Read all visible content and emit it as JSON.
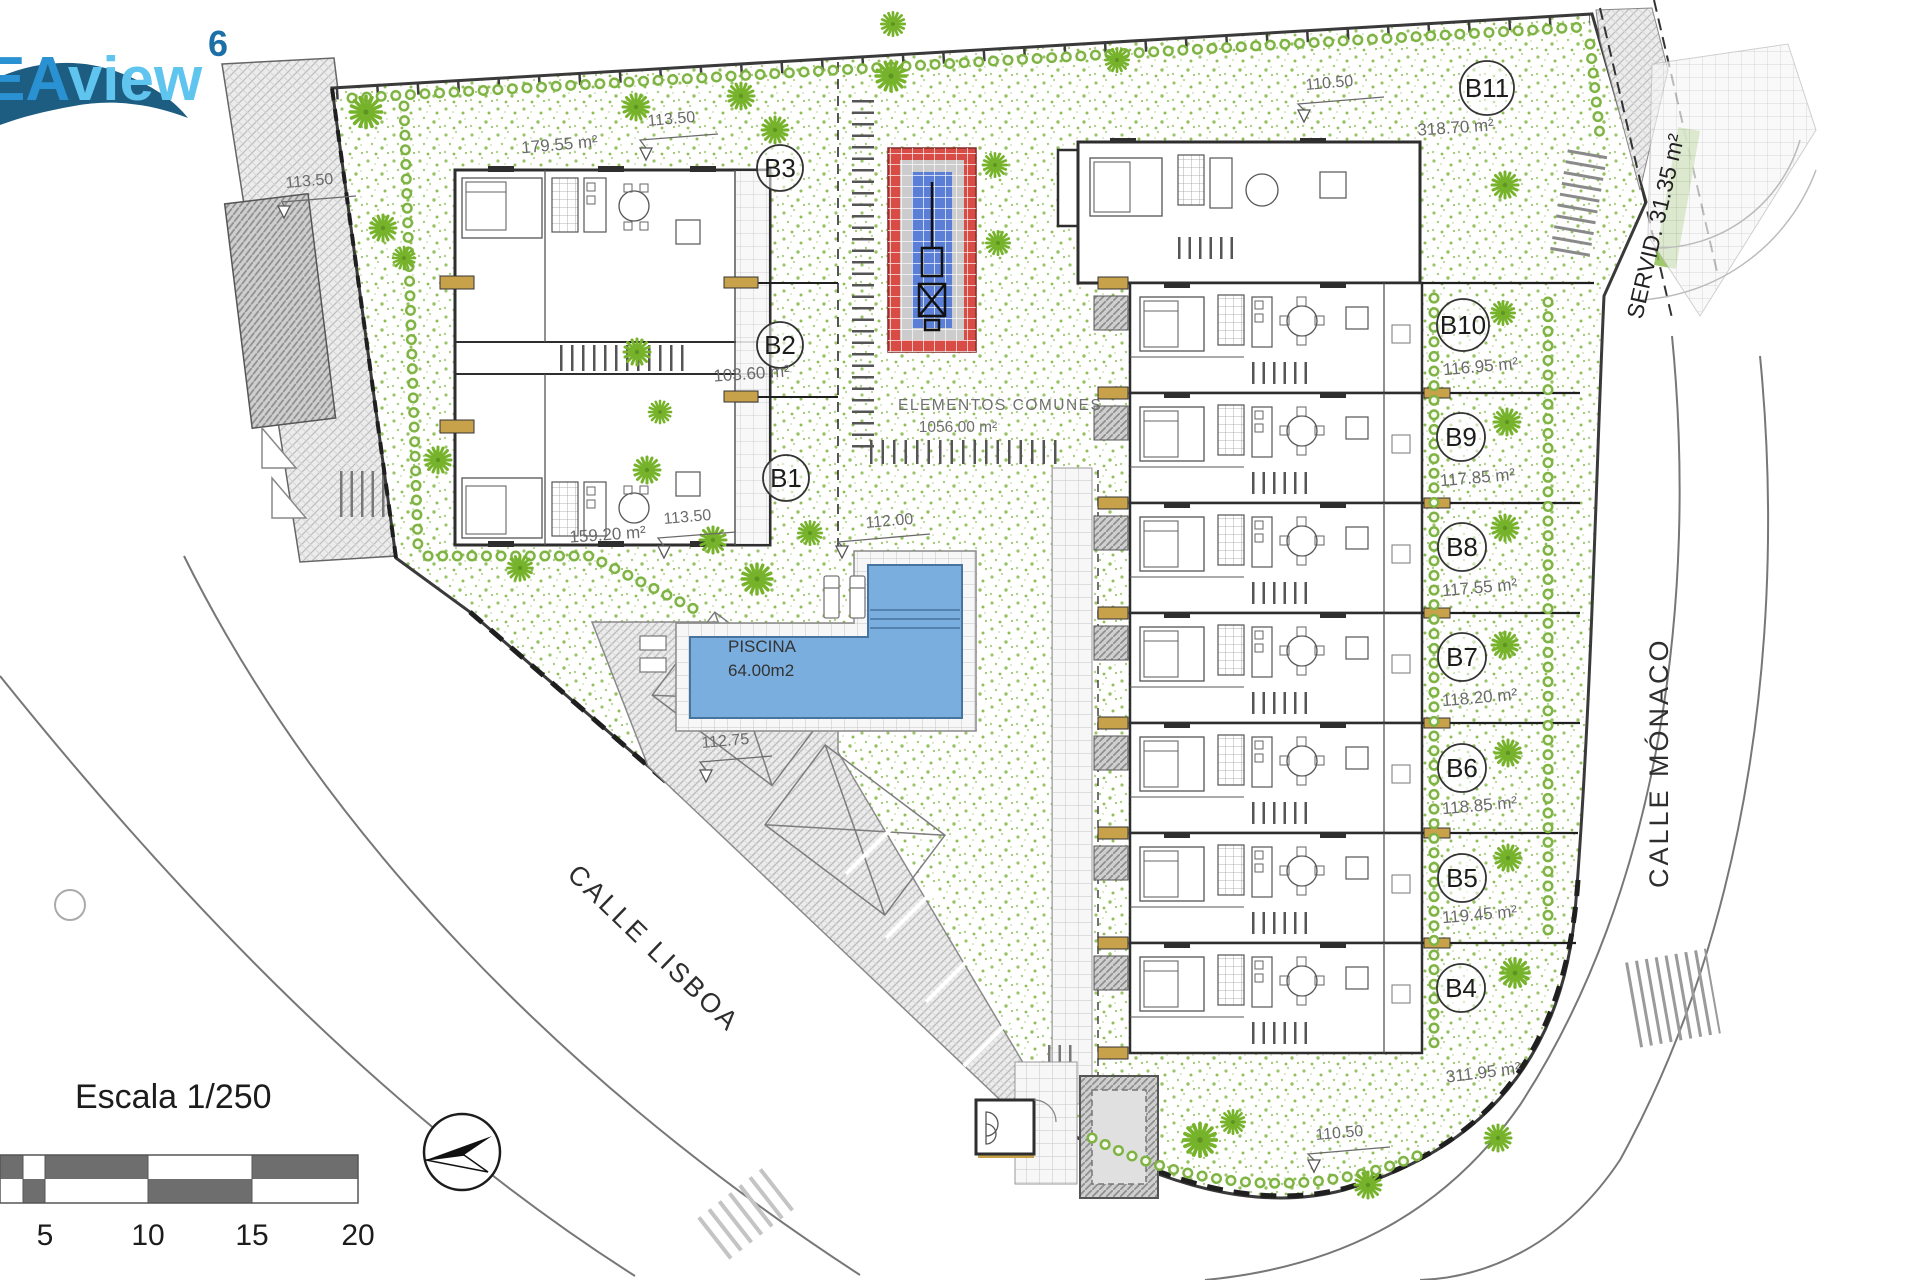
{
  "logo": {
    "prefix": "EA",
    "suffix": "view",
    "superscript": "6"
  },
  "streets": {
    "lisboa": "CALLE LISBOA",
    "monaco": "CALLE MÓNACO"
  },
  "servitude_label": "SERVID. 31.35 m²",
  "common_area": {
    "title": "ELEMENTOS COMUNES",
    "area": "1056.00 m²"
  },
  "pool": {
    "title": "PISCINA",
    "area": "64.00m2"
  },
  "scale_bar": {
    "title": "Escala 1/250",
    "ticks": [
      "5",
      "10",
      "15",
      "20"
    ]
  },
  "units": [
    {
      "id": "B1",
      "area": "159.20 m²"
    },
    {
      "id": "B2",
      "area": "103.60 m²"
    },
    {
      "id": "B3",
      "area": "179.55 m²"
    },
    {
      "id": "B4",
      "area": "311.95 m²"
    },
    {
      "id": "B5",
      "area": "119.45 m²"
    },
    {
      "id": "B6",
      "area": "118.85 m²"
    },
    {
      "id": "B7",
      "area": "118.20 m²"
    },
    {
      "id": "B8",
      "area": "117.55 m²"
    },
    {
      "id": "B9",
      "area": "117.85 m²"
    },
    {
      "id": "B10",
      "area": "116.95 m²"
    },
    {
      "id": "B11",
      "area": "318.70 m²"
    }
  ],
  "elevations": {
    "far_left": "113.50",
    "b3_garden": "113.50",
    "b1_garden": "113.50",
    "pool_area": "112.00",
    "parking": "112.75",
    "b11_garden": "110.50",
    "b4_garden": "110.50"
  },
  "colors": {
    "garden_dot": "#8fbe54",
    "pool_water": "#7aaede",
    "fountain_red": "#d94b45",
    "fountain_blue": "#5b7fd6",
    "logo_dark": "#2a92d2",
    "logo_light": "#5fc5ef",
    "logo_wave": "#1d5d82",
    "entrance_tan": "#c8a24a"
  }
}
